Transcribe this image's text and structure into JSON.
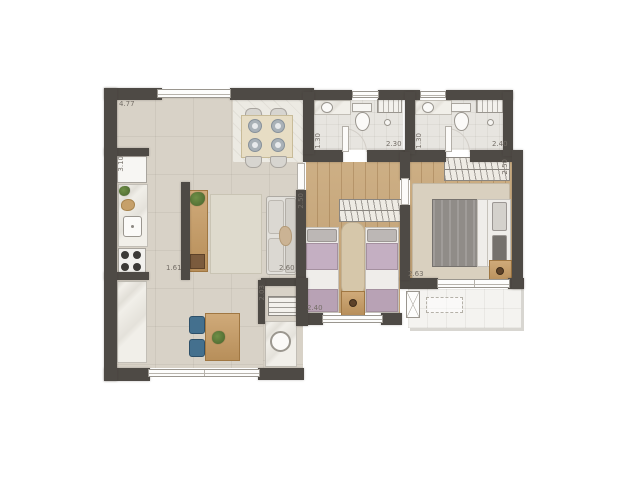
{
  "plan": {
    "type": "apartment-floor-plan",
    "background": "#ffffff",
    "wall_color": "#4e4a45",
    "wood_floor_color": "#c9a87a",
    "tile_floor_color": "#d8d2c7",
    "accent_blue": "#44708e",
    "accent_lavender": "#c4afc2"
  },
  "dimensions": {
    "top_width": "4.77",
    "kitchen_height": "3.10",
    "bath1_width": "2.30",
    "bath1_height": "1.30",
    "bath2_width": "2.40",
    "bath2_height": "1.30",
    "bedroom1_height": "2.50",
    "bedroom1_width": "2.40",
    "master_wardrobe_width": "2.50",
    "master_width": "2.63",
    "living_width": "2.60",
    "kitchen_passage": "1.61",
    "laundry_height": "2.03"
  }
}
